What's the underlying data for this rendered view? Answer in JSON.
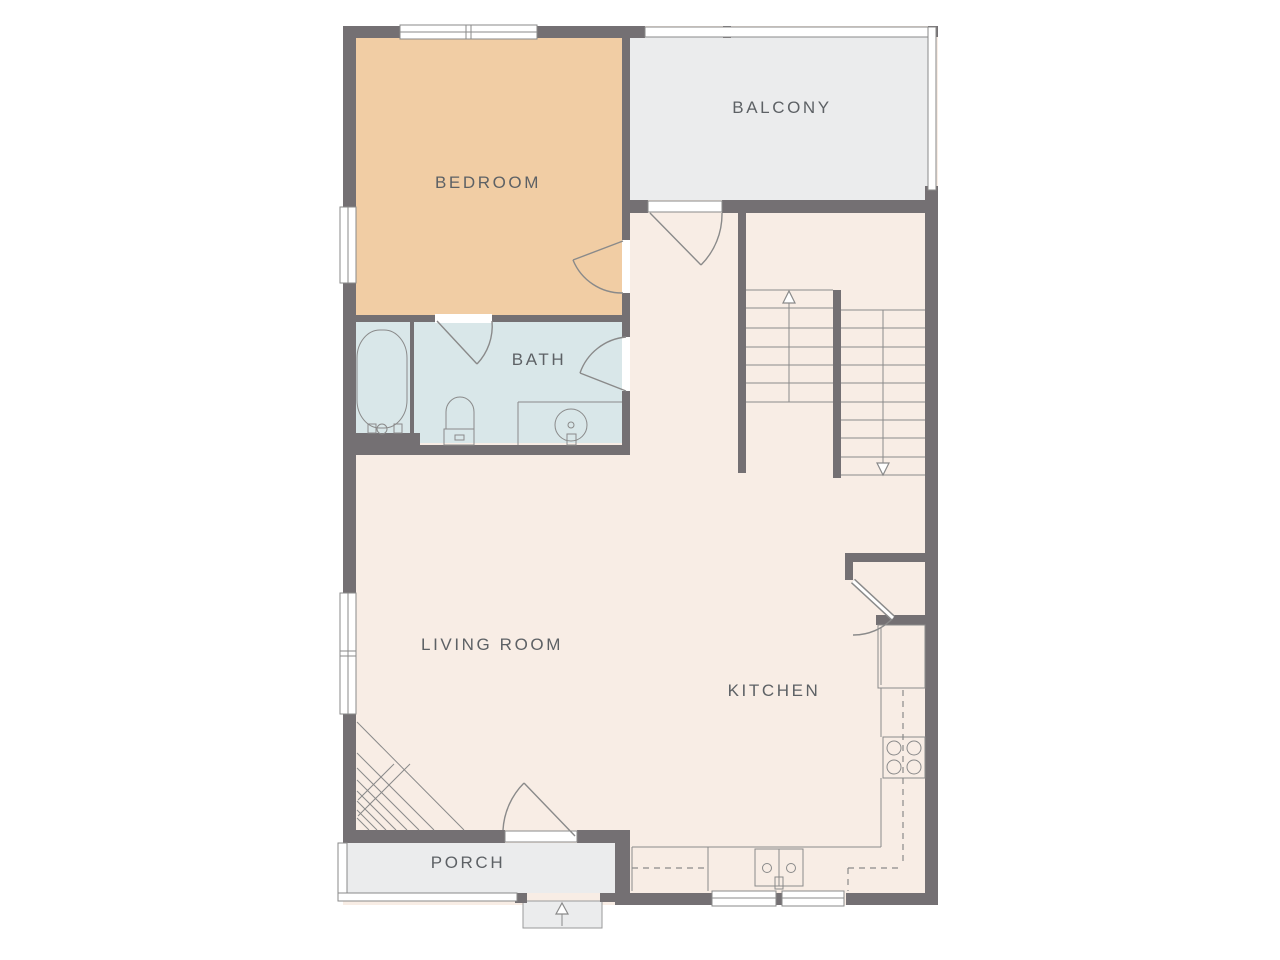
{
  "plan_title": "apartment floor plan",
  "rooms": [
    {
      "id": "bedroom",
      "label": "BEDROOM"
    },
    {
      "id": "balcony",
      "label": "BALCONY"
    },
    {
      "id": "bath",
      "label": "BATH"
    },
    {
      "id": "living-room",
      "label": "LIVING ROOM"
    },
    {
      "id": "kitchen",
      "label": "KITCHEN"
    },
    {
      "id": "porch",
      "label": "PORCH"
    }
  ],
  "colors": {
    "wall": "#747073",
    "floor": "#f8ede5",
    "bedroom": "#f1cda4",
    "bath": "#d9e7e9",
    "outdoor": "#ebeced",
    "line": "#8a8a8a",
    "label": "#5d6165"
  },
  "stairs": {
    "upper_flight_direction": "up",
    "lower_flight_direction": "down"
  },
  "entries": {
    "porch_steps_direction": "up"
  }
}
